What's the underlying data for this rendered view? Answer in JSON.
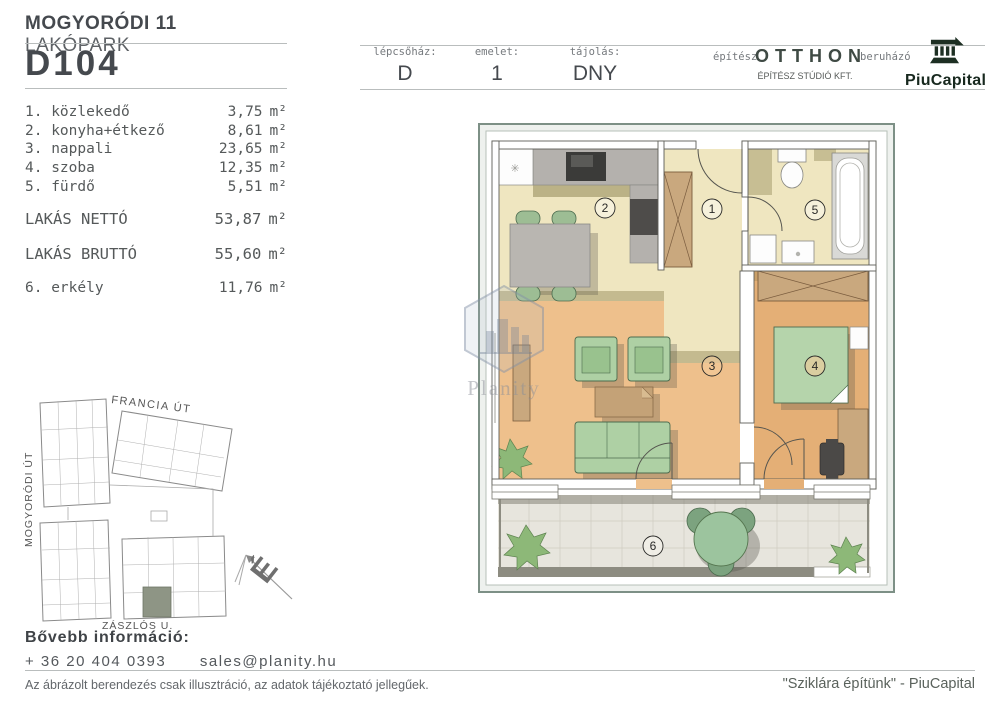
{
  "header": {
    "project_name_bold": "MOGYORÓDI 11",
    "project_name_light": "LAKÓPARK",
    "unit_id": "D104",
    "info_cells": [
      {
        "label": "lépcsőház:",
        "value": "D"
      },
      {
        "label": "emelet:",
        "value": "1"
      },
      {
        "label": "tájolás:",
        "value": "DNY"
      }
    ],
    "architect_label": "építész",
    "architect_logo_main": "OTTHON",
    "architect_logo_sub": "ÉPÍTÉSZ STÚDIÓ KFT.",
    "developer_label": "beruházó",
    "developer_logo": "PiuCapital"
  },
  "area_table": {
    "unit": "m²",
    "rooms": [
      {
        "label": "1. közlekedő",
        "value": "3,75"
      },
      {
        "label": "2. konyha+étkező",
        "value": "8,61"
      },
      {
        "label": "3. nappali",
        "value": "23,65"
      },
      {
        "label": "4. szoba",
        "value": "12,35"
      },
      {
        "label": "5. fürdő",
        "value": "5,51"
      }
    ],
    "totals": [
      {
        "label": "LAKÁS NETTÓ",
        "value": "53,87"
      },
      {
        "label": "LAKÁS BRUTTÓ",
        "value": "55,60"
      }
    ],
    "outdoor": {
      "label": "6. erkély",
      "value": "11,76"
    }
  },
  "floorplan": {
    "watermark": "Planity",
    "room_numbers": [
      "1",
      "2",
      "3",
      "4",
      "5",
      "6"
    ]
  },
  "site_map": {
    "street_top": "FRANCIA ÚT",
    "street_left": "MOGYORÓDI ÚT",
    "street_bottom": "ZÁSZLÓS U.",
    "north_label": "É"
  },
  "contact": {
    "heading": "Bővebb információ:",
    "phone": "+ 36 20 404 0393",
    "email": "sales@planity.hu"
  },
  "footer": {
    "disclaimer": "Az ábrázolt berendezés csak illusztráció, az adatok tájékoztató jellegűek.",
    "slogan": "\"Sziklára építünk\" - PiuCapital"
  },
  "colors": {
    "accent_dark": "#45494e",
    "floor_cream": "#efe6c0",
    "floor_wood": "#eec08c",
    "furniture_green": "#aed0a4",
    "logo_green": "#1d2f23"
  }
}
